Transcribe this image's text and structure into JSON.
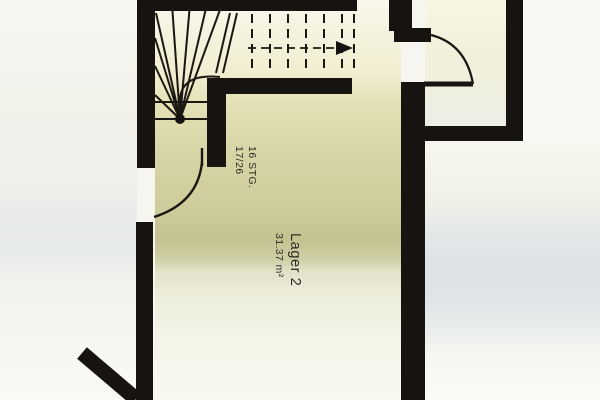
{
  "plan": {
    "room": {
      "name": "Lager 2",
      "area": "31.37 m²"
    },
    "stair_note": {
      "line1": "16 STG.",
      "line2": "17/26"
    },
    "icons": {
      "stair_direction": "stair-direction-arrow"
    },
    "colors": {
      "wall_black": "#171310",
      "line_black": "#1b1713",
      "olive_wash": "#c4c28f",
      "blue_gray_band": "#dde2e6",
      "cream": "#f8f6e4",
      "paper": "#f6f5ef",
      "text": "#2b2b26"
    }
  }
}
